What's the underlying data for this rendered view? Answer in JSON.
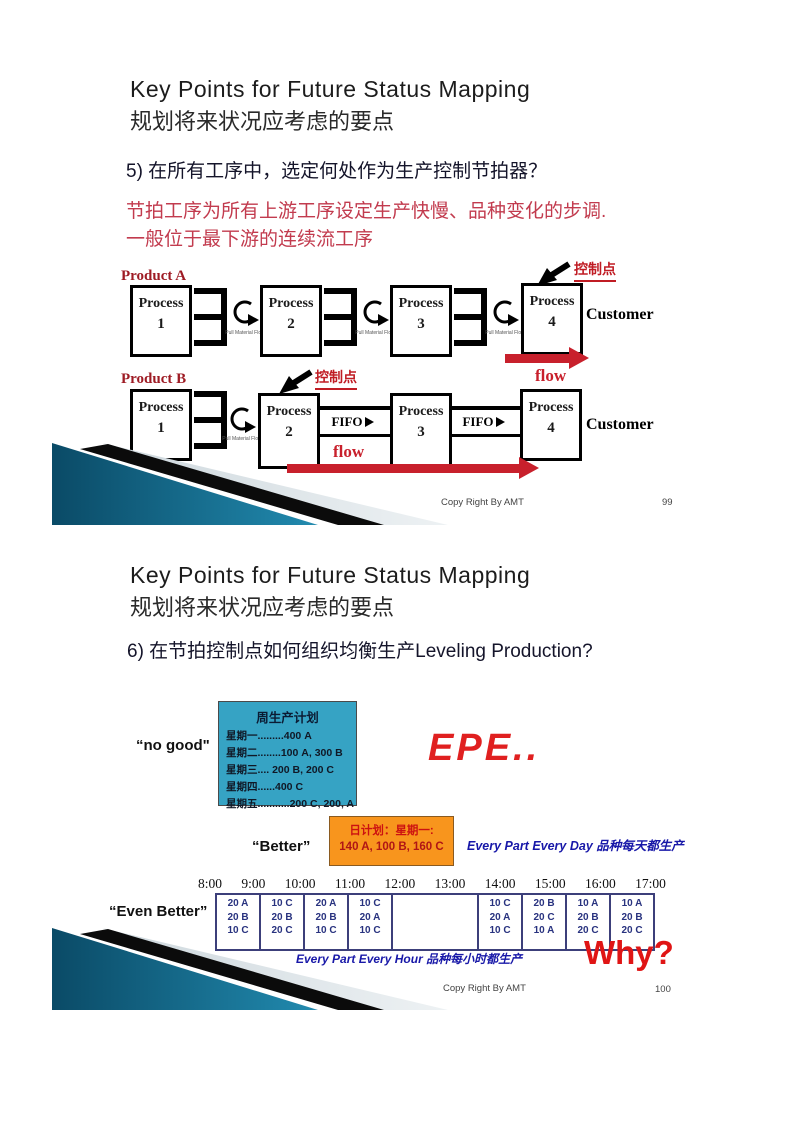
{
  "colors": {
    "accent_red": "#c8202c",
    "note_red": "#c23b4e",
    "deco_teal": "#1f84a8",
    "weekly_box_cyan": "#36a3c4",
    "daily_box_orange": "#f8951d",
    "schedule_navy": "#28327f"
  },
  "slide1": {
    "title": "Key Points for Future Status Mapping",
    "subtitle": "规划将来状况应考虑的要点",
    "point": "5) 在所有工序中，选定何处作为生产控制节拍器？",
    "note1": "节拍工序为所有上游工序设定生产快慢、品种变化的步调.",
    "note2": "一般位于最下游的连续流工序",
    "process_word": "Process",
    "customer": "Customer",
    "control_point": "控制点",
    "flow": "flow",
    "fifo": "FIFO",
    "pull": "Pull Material Flow",
    "rowA": {
      "label": "Product A",
      "numbers": [
        "1",
        "2",
        "3",
        "4"
      ]
    },
    "rowB": {
      "label": "Product B",
      "numbers": [
        "1",
        "2",
        "3",
        "4"
      ]
    },
    "footer": "Copy Right By AMT",
    "page_num": "99"
  },
  "slide2": {
    "title": "Key Points for Future Status Mapping",
    "subtitle": "规划将来状况应考虑的要点",
    "point": "6) 在节拍控制点如何组织均衡生产Leveling Production?",
    "no_good": {
      "label": "“no good\"",
      "box_title": "周生产计划",
      "lines": [
        "星期一.........400 A",
        "星期二........100 A, 300 B",
        "星期三.... 200 B, 200 C",
        "星期四......400 C",
        "星期五...........200 C, 200, A"
      ]
    },
    "epe": "EPE..",
    "better": {
      "label": "“Better”",
      "box_line1": "日计划：星期一:",
      "box_line2": "140 A, 100 B, 160 C",
      "caption": "Every Part Every Day 品种每天都生产"
    },
    "schedule": {
      "label": "“Even Better”",
      "times": [
        "8:00",
        "9:00",
        "10:00",
        "11:00",
        "12:00",
        "13:00",
        "14:00",
        "15:00",
        "16:00",
        "17:00"
      ],
      "cells": [
        [
          "20 A",
          "20 B",
          "10 C"
        ],
        [
          "10 C",
          "20 B",
          "20 C"
        ],
        [
          "20 A",
          "20 B",
          "10 C"
        ],
        [
          "10 C",
          "20 A",
          "10 C"
        ],
        [
          "",
          "",
          ""
        ],
        [
          "10 C",
          "20 A",
          "10 C"
        ],
        [
          "20 B",
          "20 C",
          "10 A"
        ],
        [
          "10 A",
          "20 B",
          "20 C"
        ],
        [
          "10 A",
          "20 B",
          "20 C"
        ]
      ],
      "caption": "Every Part Every Hour 品种每小时都生产",
      "why": "Why?"
    },
    "footer": "Copy Right By AMT",
    "page_num": "100"
  }
}
